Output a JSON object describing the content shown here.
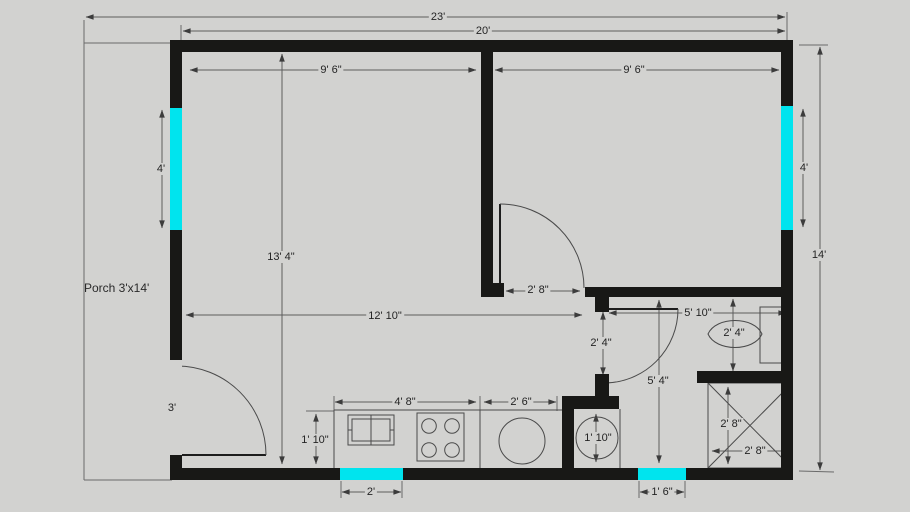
{
  "colors": {
    "background": "#d2d2d0",
    "wall": "#181816",
    "window": "#00e4ee",
    "dim_line": "#5d5d5d",
    "text": "#242424"
  },
  "porch": {
    "label": "Porch 3'x14'"
  },
  "dimensions": {
    "overall_width": "23'",
    "house_width": "20'",
    "room_left_width": "9' 6\"",
    "room_right_width": "9' 6\"",
    "window_left": "4'",
    "window_right": "4'",
    "house_height": "14'",
    "living_height": "13' 4\"",
    "living_width": "12' 10\"",
    "interior_door": "2' 8\"",
    "hall_width": "5' 10\"",
    "bath_door_height": "2' 4\"",
    "hall_height": "5' 4\"",
    "toilet_width": "2' 4\"",
    "shower_height": "2' 8\"",
    "shower_width": "2' 8\"",
    "washer_width": "1' 10\"",
    "counter_depth": "1' 10\"",
    "counter_left_width": "4' 8\"",
    "counter_right_width": "2' 6\"",
    "front_door_width": "3'",
    "kitchen_window_width": "2'",
    "small_window_width": "1' 6\""
  }
}
